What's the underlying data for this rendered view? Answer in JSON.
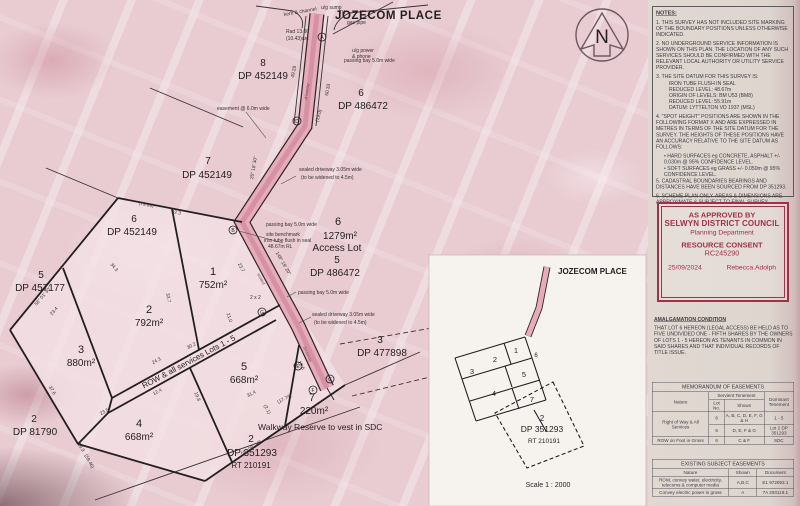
{
  "title": "JOZECOM PLACE",
  "north_letter": "N",
  "plan": {
    "lots": [
      {
        "num": "1",
        "area": "752m²"
      },
      {
        "num": "2",
        "area": "792m²"
      },
      {
        "num": "3",
        "area": "880m²"
      },
      {
        "num": "4",
        "area": "668m²"
      },
      {
        "num": "5",
        "area": "668m²"
      },
      {
        "num": "7",
        "area": "220m²"
      }
    ],
    "access_lot": {
      "num": "6",
      "area": "1279m²",
      "label": "Access Lot"
    },
    "walkway_note": "Walkway Reserve to vest in SDC",
    "row_note": "ROW & all services Lots 1 - 5",
    "neighbors": [
      {
        "num": "8",
        "dp": "DP 452149"
      },
      {
        "num": "7",
        "dp": "DP 452149"
      },
      {
        "num": "6",
        "dp": "DP 452149"
      },
      {
        "num": "5",
        "dp": "DP 457177"
      },
      {
        "num": "2",
        "dp": "DP 81790"
      },
      {
        "num": "6",
        "dp": "DP 486472"
      },
      {
        "num": "5",
        "dp": "DP 486472"
      },
      {
        "num": "3",
        "dp": "DP 477898"
      },
      {
        "num": "2",
        "dp": "DP 351293",
        "rt": "RT 210191"
      }
    ],
    "ann": {
      "kerb": "kerb & channel",
      "sump": "u/g sump",
      "tk": "TK",
      "gas": "gas pipe",
      "rad1": "Rad 13.00",
      "rad2": "(10.43)arc",
      "power1": "u/g power",
      "power2": "& phone",
      "passing": "passing bay 5.0m wide",
      "easement": "easement @ 6.0m wide",
      "sealed1": "sealed driveway 3.05m wide",
      "sealed2": "(to be widened to 4.5m)",
      "bench1": "site benchmark",
      "bench2": "iron tube flush in seal",
      "bench3": "48.67m RL",
      "grid": "2 x 2",
      "driveway": "driveway",
      "sealed": "sealed"
    },
    "dims": [
      "26° 18' 30\"",
      "60.33",
      "49.28",
      "(19.0)",
      "148° 19' 20\"",
      "23.7",
      "33.7",
      "32.3",
      "(79.99)",
      "34.3",
      "58° 01' 30\"",
      "23.4",
      "21.0",
      "24.3",
      "30.2",
      "12.4",
      "19.8",
      "23.5",
      "37.6",
      "16.9",
      "(59.46)",
      "58° 06' 20\"",
      "31.4",
      "(17.74)",
      "(2.1)",
      "18.6"
    ],
    "marks": [
      "A",
      "B",
      "D",
      "G",
      "E",
      "C",
      "F"
    ]
  },
  "inset": {
    "street": "JOZECOM PLACE",
    "lots": [
      "1",
      "2",
      "3",
      "5",
      "4",
      "7",
      "6"
    ],
    "parcel": {
      "num": "2",
      "dp": "DP 351293",
      "rt": "RT 210191"
    },
    "scale": "Scale 1 : 2000"
  },
  "panel": {
    "notes_title": "NOTES:",
    "notes": [
      "1.   THIS SURVEY HAS NOT INCLUDED SITE MARKING OF THE BOUNDARY POSITIONS UNLESS OTHERWISE INDICATED.",
      "2.   NO UNDERGROUND SERVICE INFORMATION IS SHOWN ON THIS PLAN. THE LOCATION OF ANY SUCH SERVICES SHOULD BE CONFIRMED WITH THE RELEVANT LOCAL AUTHORITY OR UTILITY SERVICE PROVIDER.",
      "3.   THE SITE DATUM FOR THIS SURVEY IS:"
    ],
    "datum_lines": [
      "IRON TUBE FLUSH IN SEAL",
      "REDUCED LEVEL:  48.67m",
      "ORIGIN OF LEVELS:  BM U53 (BM8)",
      "REDUCED LEVEL:  55.91m",
      "DATUM:  LYTTELTON VD 1937 (MSL)"
    ],
    "note4": "4.   \"SPOT HEIGHT\" POSITIONS ARE SHOWN IN THE FOLLOWING FORMAT X AND ARE EXPRESSED IN METRES IN TERMS OF THE SITE DATUM FOR THE SURVEY. THE HEIGHTS OF THESE POSITIONS HAVE AN ACCURACY RELATIVE TO THE SITE DATUM AS FOLLOWS:",
    "bullets": [
      "• HARD SURFACES eg CONCRETE, ASPHALT  +/- 0.030m @ 95% CONFIDENCE LEVEL.",
      "• SOFT SURFACES eg GRASS   +/- 0.050m @ 95% CONFIDENCE LEVEL."
    ],
    "note5": "5.   CADASTRAL BOUNDARIES BEARINGS AND DISTANCES HAVE BEEN SOURCED FROM DP 351293.",
    "note6": "6.   SCHEME PLAN ONLY. AREAS & DIMENSIONS ARE APPROXIMATE & SUBJECT TO FINAL SURVEY.",
    "stamp": {
      "line1": "AS APPROVED BY",
      "line2": "SELWYN DISTRICT COUNCIL",
      "line3": "Planning Department",
      "line4": "RESOURCE CONSENT",
      "line5": "RC245290",
      "date": "25/09/2024",
      "signed": "Rebecca.Adolph"
    },
    "amalgamation_title": "AMALGAMATION CONDITION",
    "amalgamation_text": "THAT LOT 6 HEREON (LEGAL ACCESS) BE HELD AS TO FIVE UNDIVIDED ONE - FIFTH SHARES BY THE OWNERS OF LOTS 1 - 5 HEREON AS TENANTS IN COMMON IN SAID SHARES AND THAT INDIVIDUAL RECORDS OF TITLE ISSUE.",
    "memo_table": {
      "title": "MEMORANDUM OF EASEMENTS",
      "col_nature": "Nature",
      "col_servient": "Servient Tenement",
      "col_lotno": "Lot No.",
      "col_shown": "Shown",
      "col_dominant": "Dominant Tenement",
      "rows": [
        {
          "nature": "Right of Way & All Services",
          "lot": "6",
          "shown": "A, B, C, D, E, F, G & H",
          "dominant": "1 - 5"
        },
        {
          "lot": "6",
          "shown": "D, E, F & G",
          "dominant": "Lot 2 DP 351293"
        },
        {
          "nature": "ROW on Foot in Gross",
          "lot": "6",
          "shown": "C & F",
          "dominant": "SDC"
        }
      ]
    },
    "existing_table": {
      "title": "EXISTING SUBJECT EASEMENTS",
      "col_nature": "Nature",
      "col_shown": "Shown",
      "col_document": "Document",
      "rows": [
        {
          "nature": "ROW, convey water, electricity, telecoms & computer media",
          "shown": "A,B,C",
          "document": "E1 972093.1"
        },
        {
          "nature": "Convey electric power in gross",
          "shown": "A",
          "document": "7A 293119.1"
        }
      ]
    }
  }
}
